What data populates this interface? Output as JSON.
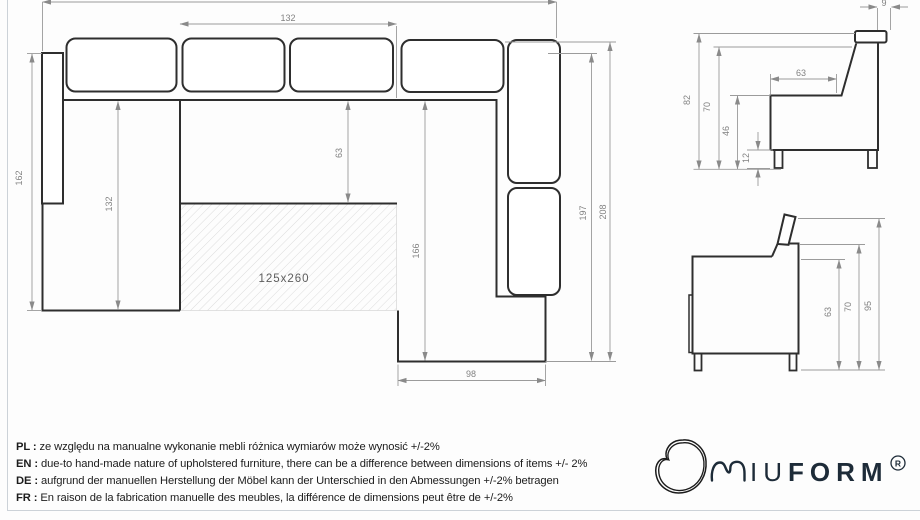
{
  "plan": {
    "bed_area_label": "125x260",
    "dim_top_width": "132",
    "dim_seat_depth": "63",
    "dim_left_depth": "132",
    "dim_left_height": "162",
    "dim_inner_length": "166",
    "dim_right_length": "197",
    "dim_total_length": "208",
    "dim_chaise_width": "98"
  },
  "side_front": {
    "dim_total_height": "82",
    "dim_back_height": "70",
    "dim_seat_height": "46",
    "dim_leg_height": "12",
    "dim_seat_depth": "63",
    "dim_headrest_depth": "9"
  },
  "side_back": {
    "dim_arm_height": "63",
    "dim_back_height": "70",
    "dim_headrest_up_height": "95"
  },
  "notes": [
    {
      "label": "PL :",
      "text": "ze względu na manualne wykonanie mebli różnica wymiarów może wynosić +/-2%"
    },
    {
      "label": "EN :",
      "text": "due-to hand-made nature of upholstered furniture, there can be a difference between dimensions of items +/- 2%"
    },
    {
      "label": "DE :",
      "text": "aufgrund der manuellen Herstellung der Möbel kann der Unterschied in den Abmessungen +/-2% betragen"
    },
    {
      "label": "FR :",
      "text": "En raison de la fabrication manuelle des meubles, la différence de dimensions peut être de +/-2%"
    }
  ],
  "logo": {
    "text_light": "IU",
    "text_bold": "FORM",
    "registered": "R"
  }
}
